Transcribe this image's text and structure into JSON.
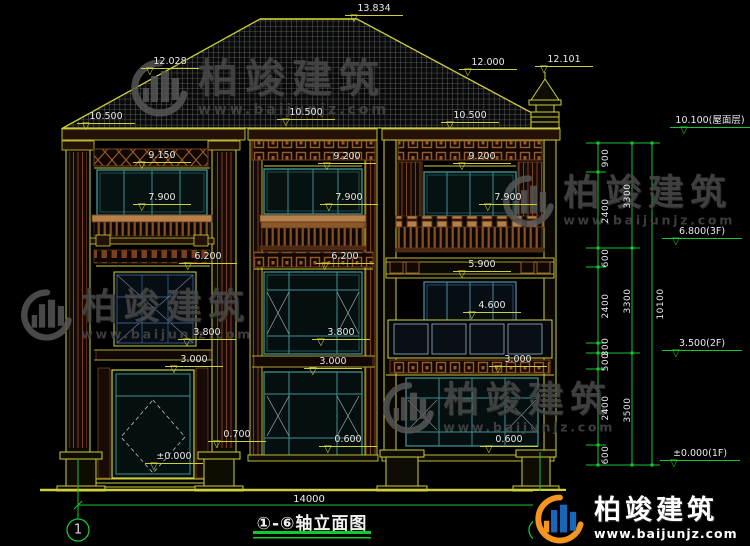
{
  "title_block": {
    "title": "①-⑥轴立面图",
    "axis_start": "1",
    "axis_end": "6",
    "total_width_dim": "14000"
  },
  "watermark": {
    "brand": "柏竣建筑",
    "url": "www.baijunjz.com"
  },
  "logo": {
    "brand": "柏竣建筑",
    "url": "www.baijunjz.com"
  },
  "colors": {
    "line_yellow": "#cfcf3a",
    "dim_green": "#12c92e",
    "window_teal": "#3f8f8f",
    "window_blue": "#4a86a0",
    "decor_brown": "#7a4020",
    "rail_light_brown": "#b5804a",
    "text_white": "#eaeaea",
    "logo_orange": "#f5941f",
    "logo_blue": "#1a66b8"
  },
  "markers": [
    {
      "text": "13.834",
      "x": 374,
      "y": 4
    },
    {
      "text": "12.028",
      "x": 170,
      "y": 57
    },
    {
      "text": "12.000",
      "x": 488,
      "y": 58
    },
    {
      "text": "12.101",
      "x": 564,
      "y": 55
    },
    {
      "text": "10.500",
      "x": 106,
      "y": 112
    },
    {
      "text": "10.500",
      "x": 306,
      "y": 108
    },
    {
      "text": "10.500",
      "x": 470,
      "y": 111
    },
    {
      "text": "9.150",
      "x": 162,
      "y": 151
    },
    {
      "text": "9.200",
      "x": 347,
      "y": 152
    },
    {
      "text": "9.200",
      "x": 482,
      "y": 152
    },
    {
      "text": "7.900",
      "x": 162,
      "y": 193
    },
    {
      "text": "7.900",
      "x": 349,
      "y": 193
    },
    {
      "text": "7.900",
      "x": 508,
      "y": 193
    },
    {
      "text": "6.200",
      "x": 208,
      "y": 252
    },
    {
      "text": "6.200",
      "x": 345,
      "y": 252
    },
    {
      "text": "5.900",
      "x": 482,
      "y": 260
    },
    {
      "text": "4.600",
      "x": 492,
      "y": 301
    },
    {
      "text": "3.800",
      "x": 207,
      "y": 328
    },
    {
      "text": "3.800",
      "x": 341,
      "y": 328
    },
    {
      "text": "3.000",
      "x": 194,
      "y": 355
    },
    {
      "text": "3.000",
      "x": 333,
      "y": 357
    },
    {
      "text": "3.000",
      "x": 518,
      "y": 355
    },
    {
      "text": "0.700",
      "x": 237,
      "y": 430
    },
    {
      "text": "0.600",
      "x": 348,
      "y": 435
    },
    {
      "text": "0.600",
      "x": 509,
      "y": 435
    },
    {
      "text": "±0.000",
      "x": 174,
      "y": 452
    }
  ],
  "level_flags": [
    {
      "text": "10.100(屋面层)",
      "x": 710,
      "y": 116
    },
    {
      "text": "6.800(3F)",
      "x": 702,
      "y": 227
    },
    {
      "text": "3.500(2F)",
      "x": 702,
      "y": 339
    },
    {
      "text": "±0.000(1F)",
      "x": 700,
      "y": 449
    }
  ],
  "dim_labels": [
    {
      "text": "900",
      "x": 606,
      "y": 158
    },
    {
      "text": "2400",
      "x": 606,
      "y": 211
    },
    {
      "text": "600",
      "x": 606,
      "y": 258
    },
    {
      "text": "2400",
      "x": 606,
      "y": 306
    },
    {
      "text": "300",
      "x": 606,
      "y": 347
    },
    {
      "text": "500",
      "x": 606,
      "y": 362
    },
    {
      "text": "2400",
      "x": 606,
      "y": 408
    },
    {
      "text": "600",
      "x": 606,
      "y": 455
    },
    {
      "text": "3300",
      "x": 628,
      "y": 196
    },
    {
      "text": "3300",
      "x": 628,
      "y": 301
    },
    {
      "text": "3500",
      "x": 628,
      "y": 410
    },
    {
      "text": "10100",
      "x": 661,
      "y": 304
    }
  ]
}
